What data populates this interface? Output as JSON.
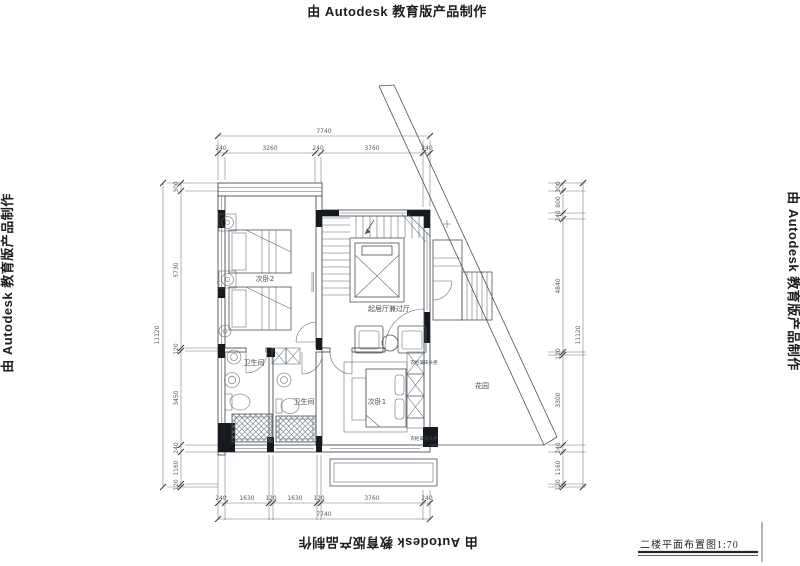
{
  "watermark": {
    "text": "由 Autodesk 教育版产品制作"
  },
  "title_block": {
    "drawing_title": "二楼平面布置图1:70"
  },
  "plan": {
    "rooms": {
      "bedroom2": "次卧2",
      "living_hall": "起居厅兼过厅",
      "bath_left": "卫生间",
      "bath_right": "卫生间",
      "bedroom1": "次卧1",
      "garden": "花园"
    },
    "fixtures": {
      "wardrobe_top": "衣柜兼床头柜",
      "wardrobe_bottom": "衣柜兼床头柜"
    }
  },
  "dimensions": {
    "top": {
      "overall": "7740",
      "chain": [
        "240",
        "3260",
        "240",
        "3760",
        "240"
      ]
    },
    "bottom": {
      "overall": "7740",
      "chain": [
        "240",
        "1630",
        "120",
        "1630",
        "120",
        "3760",
        "240"
      ]
    },
    "left": {
      "overall": "11120",
      "chain": [
        "300",
        "5730",
        "120",
        "3450",
        "240",
        "1160",
        "120"
      ]
    },
    "right": {
      "overall": "11120",
      "chain": [
        "300",
        "800",
        "240",
        "4840",
        "120",
        "3300",
        "240",
        "1160",
        "120"
      ]
    }
  },
  "colors": {
    "line": "#49525a",
    "wall_fill": "#16191d",
    "background": "#ffffff"
  }
}
